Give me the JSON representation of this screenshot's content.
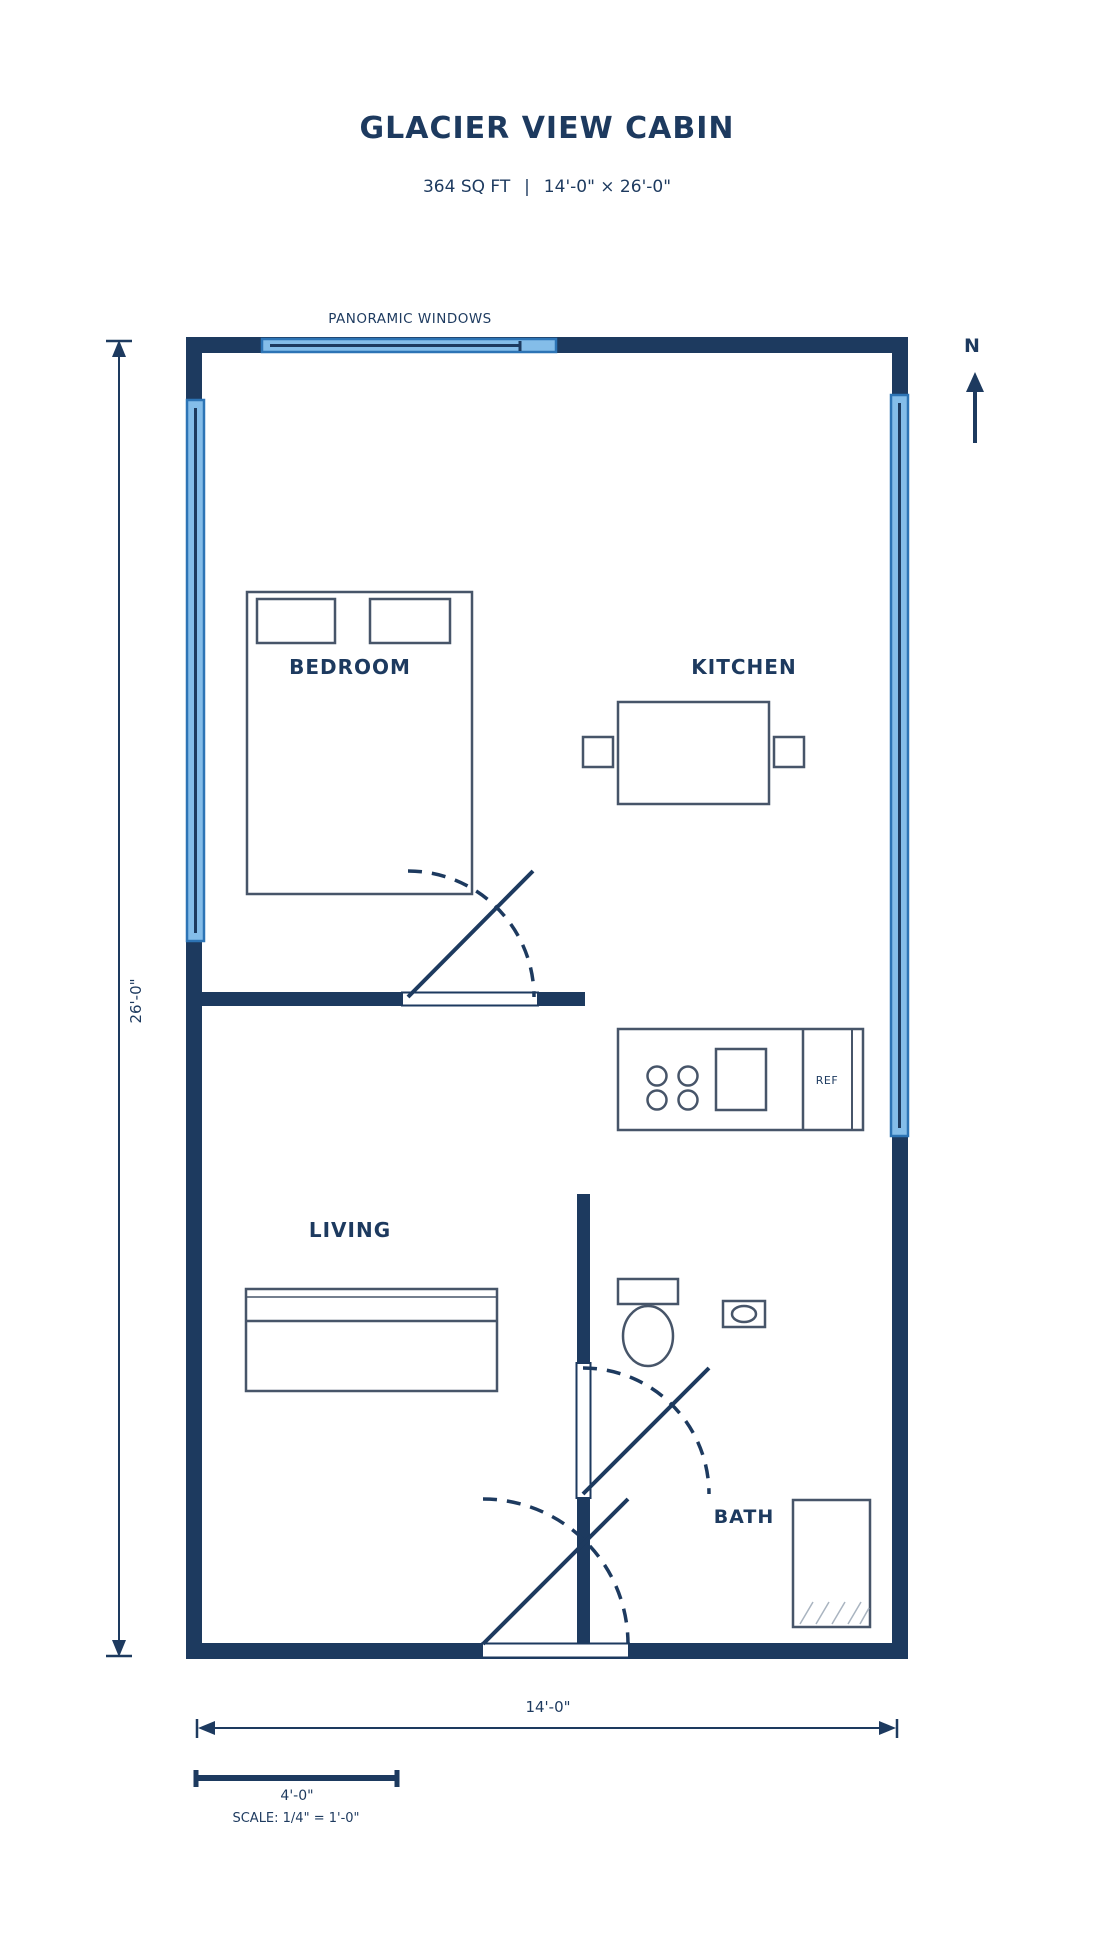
{
  "header": {
    "title": "GLACIER VIEW CABIN",
    "subtitle": "364 SQ FT  |  14'-0\" × 26'-0\""
  },
  "annotations": {
    "windows_label": "PANORAMIC WINDOWS",
    "north_label": "N"
  },
  "rooms": {
    "bedroom": "BEDROOM",
    "kitchen": "KITCHEN",
    "living": "LIVING",
    "bath": "BATH"
  },
  "fixtures": {
    "refrigerator_label": "REF"
  },
  "dimensions": {
    "width_label": "14'-0\"",
    "height_label": "26'-0\"",
    "scale_length_label": "4'-0\"",
    "scale_note": "SCALE: 1/4\" = 1'-0\""
  },
  "colors": {
    "wall_navy": "#1d3a5f",
    "furniture_stroke": "#475569",
    "window_fill": "#84bde9",
    "window_border": "#2d74b5",
    "hatch_gray": "#a9b4c0",
    "background": "#ffffff"
  }
}
